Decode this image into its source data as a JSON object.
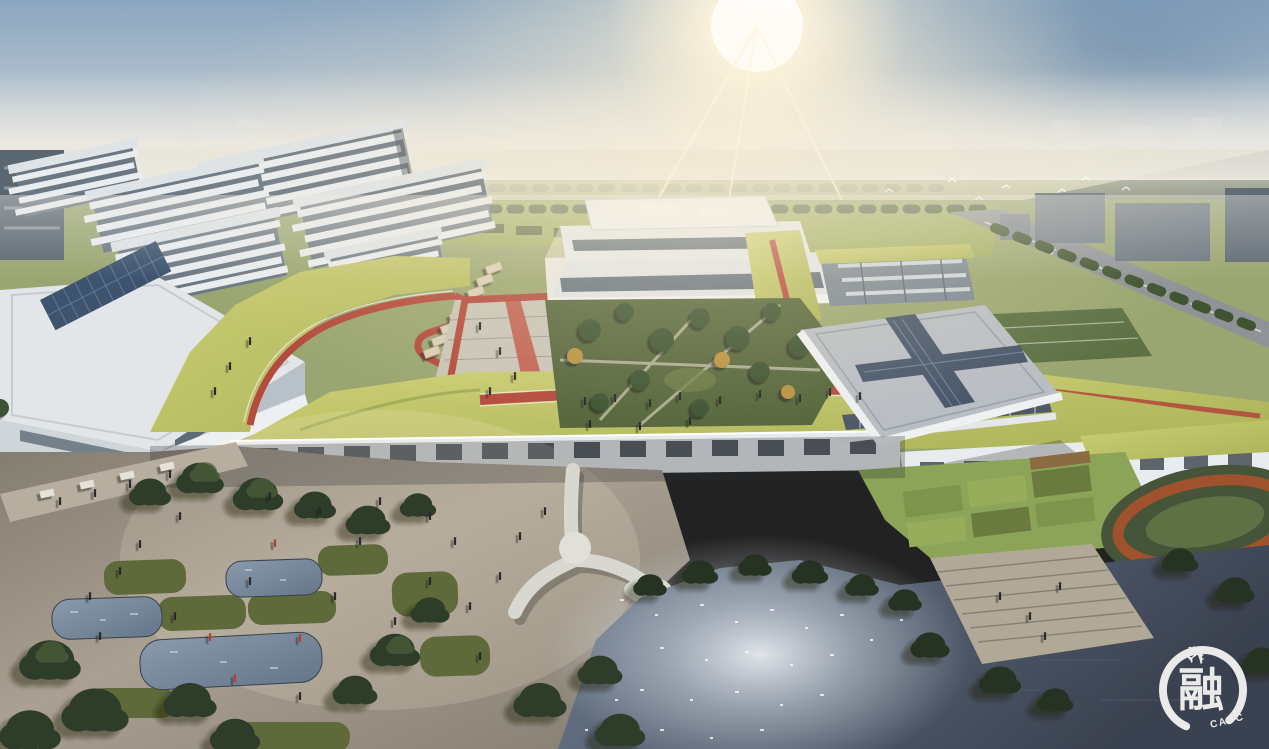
{
  "scene": {
    "type": "aerial-architectural-rendering",
    "subject": "campus masterplan with green roofs, rooftop running tracks, plaza, ponds and lake",
    "lighting": "hazy morning sun, top center, flare and bloom",
    "regions": [
      "sky-with-sun",
      "distant-city-skyline",
      "dormitory-slab-buildings",
      "central-terraced-building",
      "green-roof-deck-with-track",
      "courtyard-garden",
      "gymnasium-with-cross-skylight",
      "sports-fields",
      "foreground-plaza-with-ponds",
      "lake-with-sun-sparkle",
      "waterfront-steps",
      "watermark-logo"
    ]
  },
  "palette": {
    "sky_top": "#8ba6c0",
    "sky_mid": "#bcc8d1",
    "sky_haze": "#eae7df",
    "sun_core": "#ffffff",
    "sun_warm": "#fff3d6",
    "distant_city": "#c9d0d6",
    "far_field": "#a8ae7c",
    "far_tree": "#75855c",
    "dark_tree": "#2e3c29",
    "mid_tree": "#45583a",
    "gold_tree": "#b9923f",
    "roof_green_light": "#cdd075",
    "roof_green": "#aab257",
    "roof_green_dark": "#879a4a",
    "track_red": "#b44b3e",
    "track_lane": "#e8e1cc",
    "building_white": "#e9edef",
    "building_shadow": "#aab4bc",
    "glass_dark": "#5d6b77",
    "gym_roof": "#b9bec4",
    "skylight_blue": "#49576b",
    "courtyard_green": "#55663c",
    "lawn": "#5f6a3a",
    "plaza_light": "#aaa092",
    "plaza_shade": "#837c70",
    "steps": "#b1a898",
    "pond": "#77879b",
    "water_dark": "#3a4150",
    "water_light": "#707e90",
    "sparkle": "#eef2f6",
    "road_grey": "#8f9398",
    "canopy_tan": "#d9cfb4",
    "people_dark": "#25262a",
    "people_red": "#b63c30",
    "logo_white": "#f4f4f2"
  },
  "watermark": {
    "character": "融",
    "subtext": "CAUC",
    "airplane_icon": "✈"
  }
}
